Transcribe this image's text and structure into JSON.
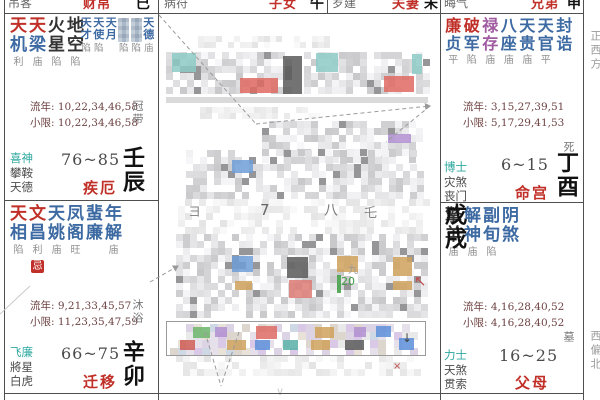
{
  "top_row": [
    {
      "god": "吊客",
      "name": "财帛",
      "branch": "巳"
    },
    {
      "god": "病符",
      "name": "子女",
      "branch": "午"
    },
    {
      "god": "岁建",
      "name": "夫妻",
      "branch": "未"
    },
    {
      "god": "晦气",
      "name": "兄弟",
      "branch": "申"
    }
  ],
  "directions": {
    "right_top": "正西方",
    "right_bottom": "西偏北"
  },
  "palaces": {
    "jie": {
      "major": [
        {
          "a": "天",
          "b": "机",
          "s": "利",
          "c": "r"
        },
        {
          "a": "天",
          "b": "梁",
          "s": "庙",
          "c": "r"
        },
        {
          "a": "火",
          "b": "星",
          "s": "陷",
          "c": "k"
        },
        {
          "a": "地",
          "b": "空",
          "s": "陷",
          "c": "k"
        }
      ],
      "minor": [
        {
          "a": "天",
          "b": "才",
          "s": "陷",
          "c": "b"
        },
        {
          "a": "天",
          "b": "使",
          "s": "陷",
          "c": "b"
        },
        {
          "a": "天",
          "b": "月",
          "s": "",
          "c": "b"
        },
        {
          "blur": true,
          "s": "陷"
        },
        {
          "blur": true,
          "s": "陷"
        },
        {
          "a": "天",
          "b": "德",
          "s": "庙",
          "c": "b"
        }
      ],
      "liunian": "流年: 10,22,34,46,58",
      "xiaoxian": "小限: 10,22,34,46,58",
      "changsheng": "冠带",
      "gods": [
        "喜神",
        "攀鞍",
        "天德"
      ],
      "age": "76~85",
      "name": "疾厄",
      "branch": "壬辰"
    },
    "qianyi": {
      "major": [
        {
          "a": "天",
          "b": "相",
          "s": "陷",
          "c": "r"
        },
        {
          "a": "文",
          "b": "昌",
          "s": "利",
          "c": "r",
          "badge": "忌"
        },
        {
          "a": "天",
          "b": "姚",
          "s": "庙",
          "c": "b"
        },
        {
          "a": "凤",
          "b": "阁",
          "s": "旺",
          "c": "b"
        },
        {
          "a": "蜚",
          "b": "廉",
          "s": "",
          "c": "b"
        },
        {
          "a": "年",
          "b": "解",
          "s": "庙",
          "c": "b"
        }
      ],
      "liunian": "流年: 9,21,33,45,57",
      "xiaoxian": "小限: 11,23,35,47,59",
      "changsheng": "沐浴",
      "gods": [
        "飞廉",
        "將星",
        "白虎"
      ],
      "age": "66~75",
      "name": "迁移",
      "branch": "辛卯"
    },
    "ming": {
      "major": [
        {
          "a": "廉",
          "b": "贞",
          "s": "平",
          "c": "r"
        },
        {
          "a": "破",
          "b": "军",
          "s": "陷",
          "c": "r"
        },
        {
          "a": "禄",
          "b": "存",
          "s": "庙",
          "c": "p"
        },
        {
          "a": "八",
          "b": "座",
          "s": "庙",
          "c": "b"
        },
        {
          "a": "天",
          "b": "贵",
          "s": "庙",
          "c": "b"
        },
        {
          "a": "天",
          "b": "官",
          "s": "平",
          "c": "b"
        },
        {
          "a": "封",
          "b": "诰",
          "s": "",
          "c": "b"
        }
      ],
      "liunian": "流年: 3,15,27,39,51",
      "xiaoxian": "小限: 5,17,29,41,53",
      "changsheng": "死",
      "gods": [
        "博士",
        "灾煞",
        "丧门"
      ],
      "age": "6~15",
      "name": "命宫",
      "branch": "丁酉"
    },
    "fumu": {
      "major": [
        {
          "a": "擎",
          "b": "羊",
          "s": "庙",
          "c": "k"
        },
        {
          "a": "解",
          "b": "神",
          "s": "庙",
          "c": "b"
        },
        {
          "a": "副",
          "b": "旬",
          "s": "陷",
          "c": "b"
        },
        {
          "a": "阴",
          "b": "煞",
          "s": "",
          "c": "b"
        }
      ],
      "liunian": "流年: 4,16,28,40,52",
      "xiaoxian": "小限: 4,16,28,40,52",
      "changsheng": "墓",
      "gods": [
        "力士",
        "天煞",
        "贯索"
      ],
      "age": "16~25",
      "name": "父母",
      "branch": "戊戌"
    }
  },
  "colors": {
    "star_red": "#c03028",
    "star_blue": "#3d6aa2",
    "star_purple": "#a05aa0",
    "god_teal": "#2fa8a0",
    "palace_red": "#c03028",
    "border": "#4f4f4f"
  },
  "center_blur": {
    "regions": [
      {
        "x": 198,
        "y": 36,
        "w": 132,
        "h": 13,
        "m": "light",
        "cs": 6
      },
      {
        "x": 166,
        "y": 52,
        "w": 128,
        "h": 44,
        "cs": 7
      },
      {
        "x": 304,
        "y": 52,
        "w": 122,
        "h": 44,
        "cs": 7
      },
      {
        "x": 166,
        "y": 97,
        "w": 262,
        "h": 6,
        "solid": "#dadada"
      },
      {
        "x": 200,
        "y": 107,
        "w": 118,
        "h": 11,
        "m": "light",
        "cs": 6
      },
      {
        "x": 262,
        "y": 121,
        "w": 162,
        "h": 38,
        "cs": 7
      },
      {
        "x": 186,
        "y": 150,
        "w": 238,
        "h": 48,
        "cs": 7
      },
      {
        "x": 178,
        "y": 199,
        "w": 248,
        "h": 34,
        "m": "light",
        "cs": 7
      },
      {
        "x": 176,
        "y": 234,
        "w": 252,
        "h": 84,
        "cs": 7
      },
      {
        "x": 170,
        "y": 324,
        "w": 250,
        "h": 27,
        "m": "color",
        "cs": 8
      },
      {
        "x": 176,
        "y": 355,
        "w": 244,
        "h": 20,
        "m": "light",
        "cs": 7
      }
    ],
    "accents": [
      {
        "x": 172,
        "y": 53,
        "w": 24,
        "h": 19,
        "c": "#8ccac6"
      },
      {
        "x": 316,
        "y": 53,
        "w": 22,
        "h": 19,
        "c": "#8ccac6"
      },
      {
        "x": 240,
        "y": 78,
        "w": 38,
        "h": 15,
        "c": "#df6a62"
      },
      {
        "x": 384,
        "y": 76,
        "w": 30,
        "h": 16,
        "c": "#df6a62"
      },
      {
        "x": 283,
        "y": 56,
        "w": 19,
        "h": 38,
        "c": "#5a5a5a"
      },
      {
        "x": 412,
        "y": 54,
        "w": 10,
        "h": 20,
        "c": "#8ccac6"
      },
      {
        "x": 388,
        "y": 134,
        "w": 23,
        "h": 9,
        "c": "#b08fd0"
      },
      {
        "x": 232,
        "y": 160,
        "w": 21,
        "h": 13,
        "c": "#6f9ed6"
      },
      {
        "x": 232,
        "y": 256,
        "w": 21,
        "h": 16,
        "c": "#6f9ed6"
      },
      {
        "x": 287,
        "y": 257,
        "w": 21,
        "h": 21,
        "c": "#5a5a5a"
      },
      {
        "x": 289,
        "y": 280,
        "w": 23,
        "h": 18,
        "c": "#dd7a74"
      },
      {
        "x": 337,
        "y": 256,
        "w": 21,
        "h": 16,
        "c": "#cfa15c"
      },
      {
        "x": 393,
        "y": 257,
        "w": 19,
        "h": 19,
        "c": "#cfa15c"
      },
      {
        "x": 393,
        "y": 281,
        "w": 19,
        "h": 9,
        "c": "#cfa15c"
      },
      {
        "x": 235,
        "y": 281,
        "w": 17,
        "h": 9,
        "c": "#cfa15c"
      },
      {
        "x": 337,
        "y": 275,
        "w": 4,
        "h": 18,
        "c": "#3f9d44"
      },
      {
        "x": 193,
        "y": 327,
        "w": 17,
        "h": 11,
        "c": "#6cb56c"
      },
      {
        "x": 215,
        "y": 327,
        "w": 12,
        "h": 10,
        "c": "#b08fd0"
      },
      {
        "x": 256,
        "y": 326,
        "w": 21,
        "h": 13,
        "c": "#dd6b65"
      },
      {
        "x": 315,
        "y": 327,
        "w": 19,
        "h": 11,
        "c": "#cfa15c"
      },
      {
        "x": 354,
        "y": 327,
        "w": 12,
        "h": 10,
        "c": "#b08fd0"
      },
      {
        "x": 376,
        "y": 326,
        "w": 15,
        "h": 11,
        "c": "#5c8ed9"
      },
      {
        "x": 180,
        "y": 340,
        "w": 15,
        "h": 10,
        "c": "#cc5a54"
      },
      {
        "x": 227,
        "y": 340,
        "w": 19,
        "h": 10,
        "c": "#cfa15c"
      },
      {
        "x": 255,
        "y": 340,
        "w": 15,
        "h": 10,
        "c": "#5c8ed9"
      },
      {
        "x": 283,
        "y": 340,
        "w": 15,
        "h": 10,
        "c": "#57b0a8"
      },
      {
        "x": 311,
        "y": 340,
        "w": 19,
        "h": 10,
        "c": "#cfa15c"
      },
      {
        "x": 345,
        "y": 340,
        "w": 19,
        "h": 10,
        "c": "#5a5a5a"
      },
      {
        "x": 399,
        "y": 338,
        "w": 15,
        "h": 12,
        "c": "#5c8ed9"
      }
    ],
    "fragments": [
      {
        "t": "ヨ",
        "x": 188,
        "y": 206,
        "s": 13,
        "c": "#8a8a8a"
      },
      {
        "t": "7",
        "x": 260,
        "y": 203,
        "s": 15,
        "c": "#666666"
      },
      {
        "t": "八",
        "x": 324,
        "y": 204,
        "s": 14,
        "c": "#777777"
      },
      {
        "t": "乇",
        "x": 364,
        "y": 207,
        "s": 13,
        "c": "#888888"
      },
      {
        "t": "九",
        "x": 348,
        "y": 266,
        "s": 10,
        "c": "#999999"
      },
      {
        "t": "20",
        "x": 341,
        "y": 276,
        "s": 11,
        "c": "#3f9d44"
      },
      {
        "t": "↖",
        "x": 414,
        "y": 274,
        "s": 15,
        "c": "#c0504d"
      },
      {
        "t": "↓",
        "x": 402,
        "y": 332,
        "s": 12,
        "c": "#444444"
      },
      {
        "t": "×",
        "x": 393,
        "y": 362,
        "s": 10,
        "c": "#c0504d"
      },
      {
        "t": "∨",
        "x": 276,
        "y": 386,
        "s": 11,
        "c": "#cccccc"
      }
    ],
    "table": {
      "x": 166,
      "y": 321,
      "w": 258,
      "h": 33
    },
    "lines": [
      {
        "x1": 159,
        "y1": 15,
        "x2": 256,
        "y2": 124,
        "d": 1
      },
      {
        "x1": 256,
        "y1": 124,
        "x2": 430,
        "y2": 106,
        "d": 1,
        "ar": 1
      },
      {
        "x1": 430,
        "y1": 106,
        "x2": 386,
        "y2": 142,
        "d": 1
      },
      {
        "x1": 205,
        "y1": 332,
        "x2": 221,
        "y2": 386,
        "d": 1
      },
      {
        "x1": 239,
        "y1": 332,
        "x2": 221,
        "y2": 386,
        "d": 1
      },
      {
        "x1": 150,
        "y1": 282,
        "x2": 178,
        "y2": 266,
        "d": 1,
        "ar": 1
      },
      {
        "x1": 0,
        "y1": 314,
        "x2": 30,
        "y2": 286,
        "d": 0
      }
    ]
  }
}
